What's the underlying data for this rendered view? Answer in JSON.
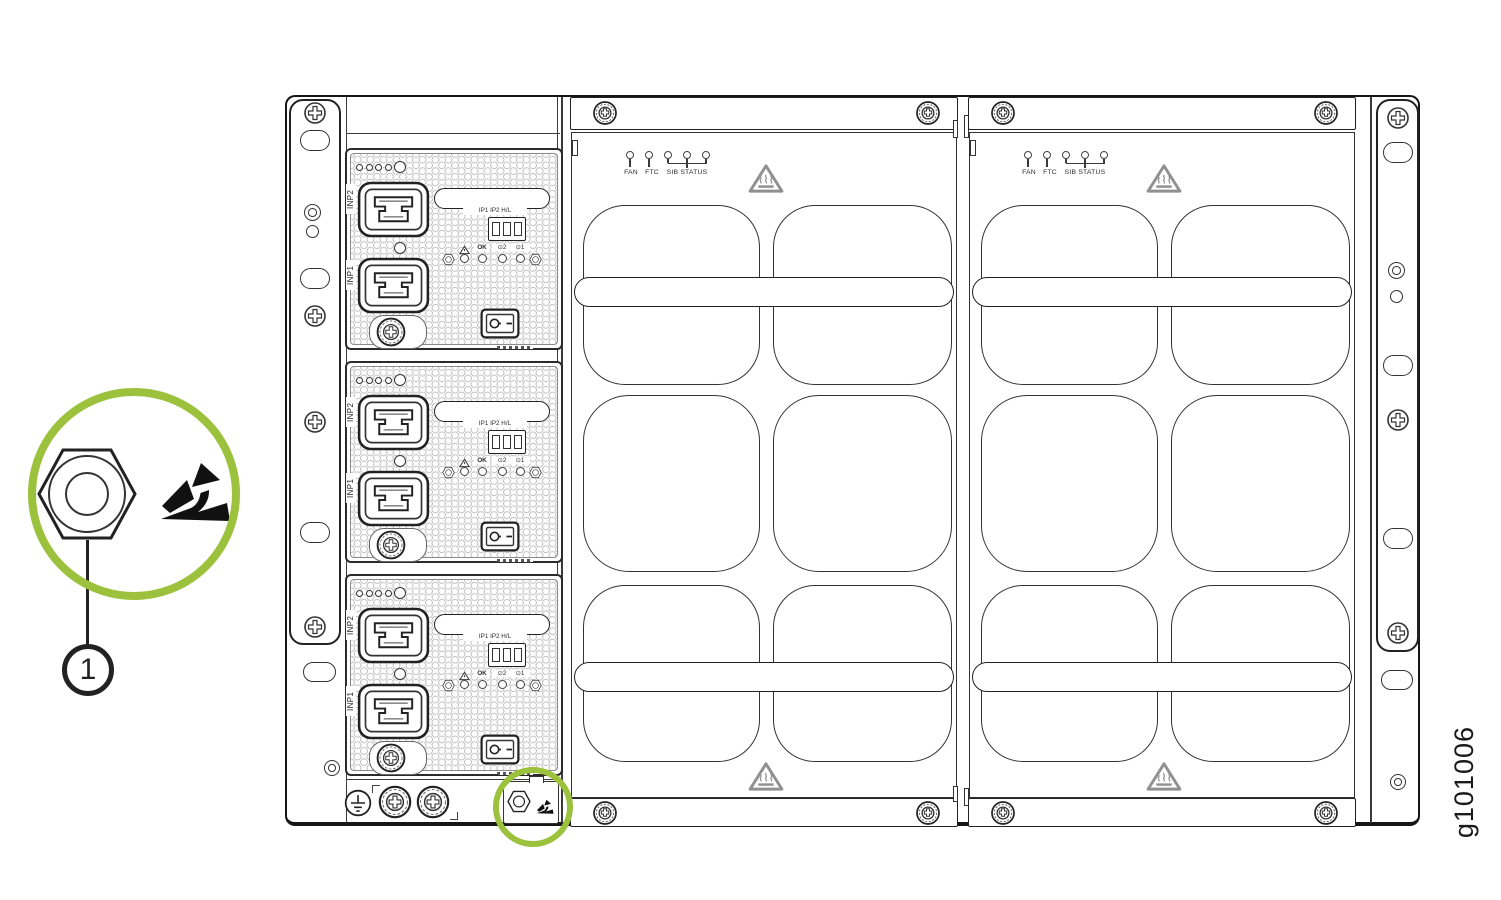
{
  "figure": {
    "id_label": "g101006"
  },
  "colors": {
    "accent_green": "#9CC23D",
    "line": "#222222"
  },
  "callout": {
    "number": "1"
  },
  "psu": {
    "labels": {
      "inp2": "INP2",
      "inp1": "INP1",
      "dip": "IP1 IP2 H/L",
      "ok": "OK",
      "outlet_symbol": "⊙",
      "outlet2": "2",
      "outlet1": "1"
    }
  },
  "fan_tray": {
    "labels": {
      "fan": "FAN",
      "ftc": "FTC",
      "sib_status": "SIB STATUS"
    }
  }
}
